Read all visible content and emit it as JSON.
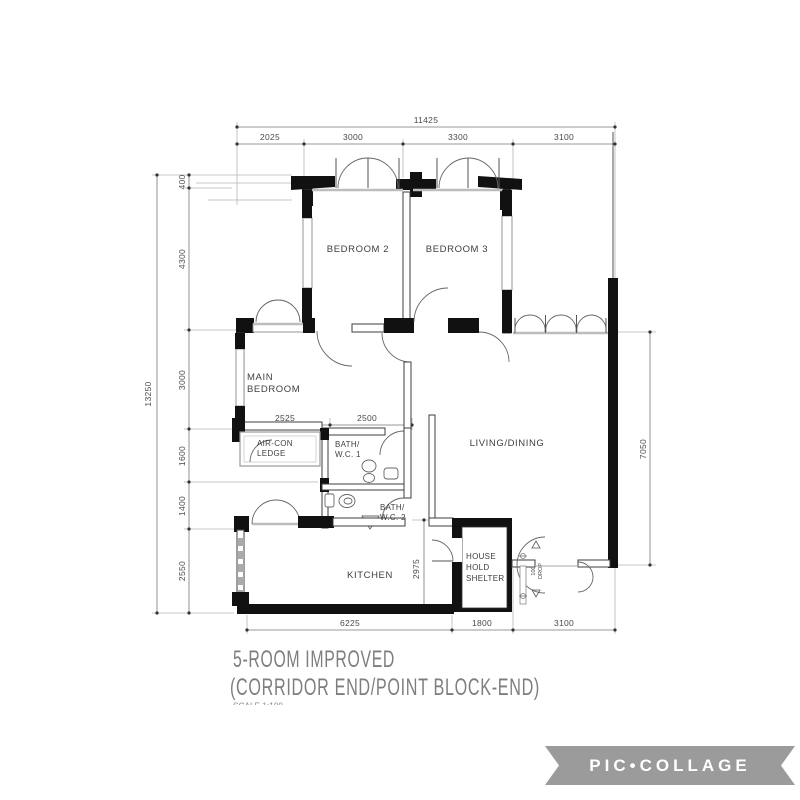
{
  "plan": {
    "rooms": {
      "bedroom2": "BEDROOM 2",
      "bedroom3": "BEDROOM 3",
      "main_bedroom_line1": "MAIN",
      "main_bedroom_line2": "BEDROOM",
      "aircon_line1": "AIR-CON",
      "aircon_line2": "LEDGE",
      "bath1_line1": "BATH/",
      "bath1_line2": "W.C. 1",
      "bath2_line1": "BATH/",
      "bath2_line2": "W.C. 2",
      "living": "LIVING/DINING",
      "kitchen": "KITCHEN",
      "shelter_line1": "HOUSE",
      "shelter_line2": "HOLD",
      "shelter_line3": "SHELTER"
    },
    "dimensions": {
      "top_total": "11425",
      "top_segments": [
        "2025",
        "3000",
        "3300",
        "3100"
      ],
      "left_total": "13250",
      "left_segments": [
        "400",
        "4300",
        "3000",
        "1600",
        "1400",
        "2550"
      ],
      "right_side": "7050",
      "bottom_segments": [
        "6225",
        "1800",
        "3100"
      ],
      "inner_width_left": "2525",
      "inner_width_right": "2500",
      "kitchen_height": "2975",
      "entrance_note_line1": "100",
      "entrance_note_line2": "DROP"
    },
    "title_line1": "5-ROOM IMPROVED",
    "title_line2": "(CORRIDOR END/POINT BLOCK-END)",
    "scale_note": "SCALE  1:100"
  },
  "watermark": {
    "text": "PIC•COLLAGE"
  },
  "colors": {
    "wall": "#111111",
    "dimension_text": "#4a4a4a",
    "title_text": "#7e7e7e",
    "watermark_bg": "#9b9b9b",
    "watermark_text": "#ffffff"
  }
}
